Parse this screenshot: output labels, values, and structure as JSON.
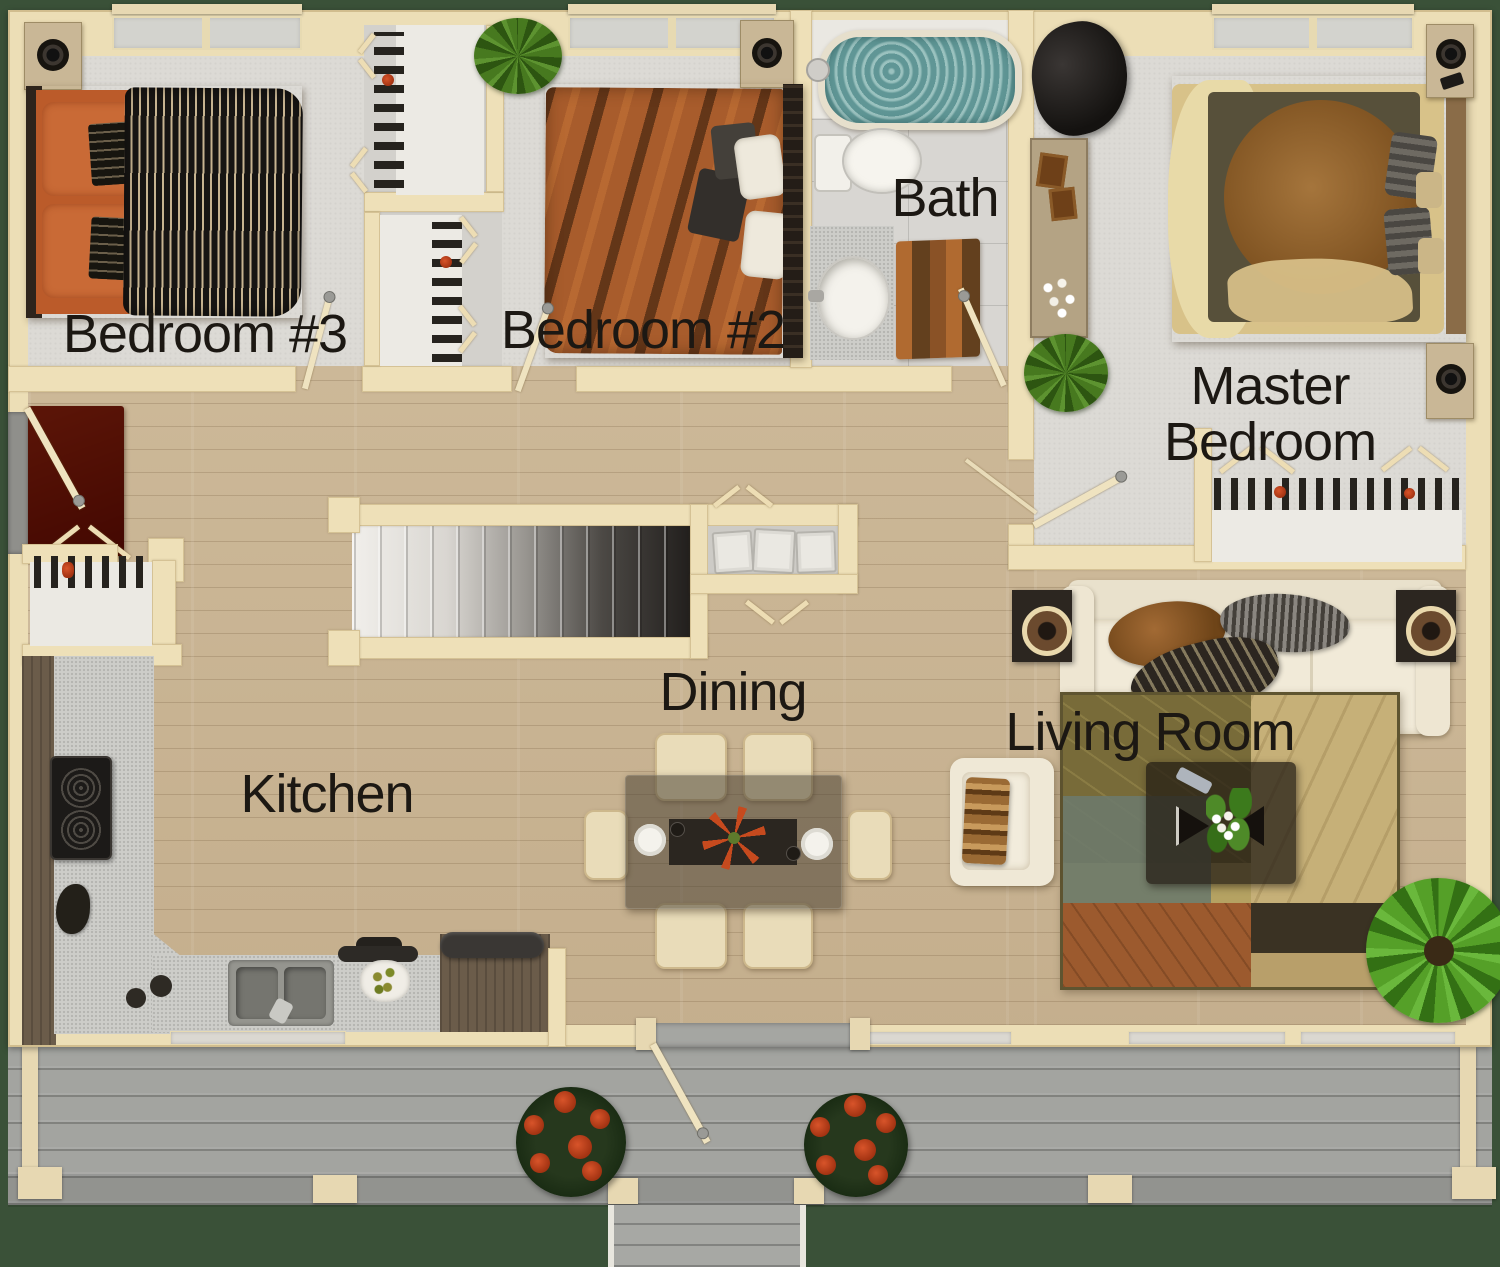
{
  "floor_plan": {
    "view": "top-down rendered residential floor plan",
    "rooms": [
      {
        "id": "bedroom-3",
        "label": "Bedroom #3"
      },
      {
        "id": "bedroom-2",
        "label": "Bedroom #2"
      },
      {
        "id": "bath",
        "label": "Bath"
      },
      {
        "id": "master-bedroom",
        "label": "Master Bedroom",
        "label_lines": [
          "Master",
          "Bedroom"
        ]
      },
      {
        "id": "kitchen",
        "label": "Kitchen"
      },
      {
        "id": "dining",
        "label": "Dining"
      },
      {
        "id": "living-room",
        "label": "Living Room"
      }
    ],
    "furnishings": {
      "bedroom-3": [
        "double bed with orange sheets and black striped duvet",
        "corner speaker cabinet",
        "closet with shoes"
      ],
      "bedroom-2": [
        "double bed with patterned orange duvet",
        "nightstand with speaker",
        "potted plant",
        "closet with shoes"
      ],
      "bath": [
        "bathtub with water",
        "toilet",
        "vanity sink",
        "wave-pattern rug"
      ],
      "master-bedroom": [
        "king bed with circle-pattern quilt",
        "two nightstands with speakers",
        "dresser with photos and flowers",
        "black lounge chair",
        "potted plant",
        "closet with shoes"
      ],
      "kitchen": [
        "L-shaped counter",
        "range with two burners",
        "double sink",
        "countertop appliances",
        "plate of food"
      ],
      "dining": [
        "glass dining table",
        "six cream chairs",
        "dark runner with red flower centerpiece",
        "two place settings"
      ],
      "living-room": [
        "three-seat sofa with throws",
        "two end tables with lamps",
        "armchair with blanket",
        "coffee table with plant and remote",
        "patchwork area rug",
        "palm plant"
      ],
      "hall": [
        "staircase",
        "storage closet",
        "pantry nook with baskets",
        "side entry door with red rug"
      ],
      "deck": [
        "gray plank deck",
        "two planters with red flowers",
        "front steps",
        "railing posts"
      ]
    },
    "palette": {
      "grass": "#3a5138",
      "wall": "#ecdeb6",
      "carpet": "#dcdad5",
      "wood_floor": "#c6b292",
      "deck": "#a3a4a0",
      "tile": "#d8d6d2",
      "label_text": "#1c1813",
      "accent_orange": "#bb5b2a",
      "tub_water": "#6fa7a6",
      "entry_rug": "#8c2f12"
    }
  }
}
